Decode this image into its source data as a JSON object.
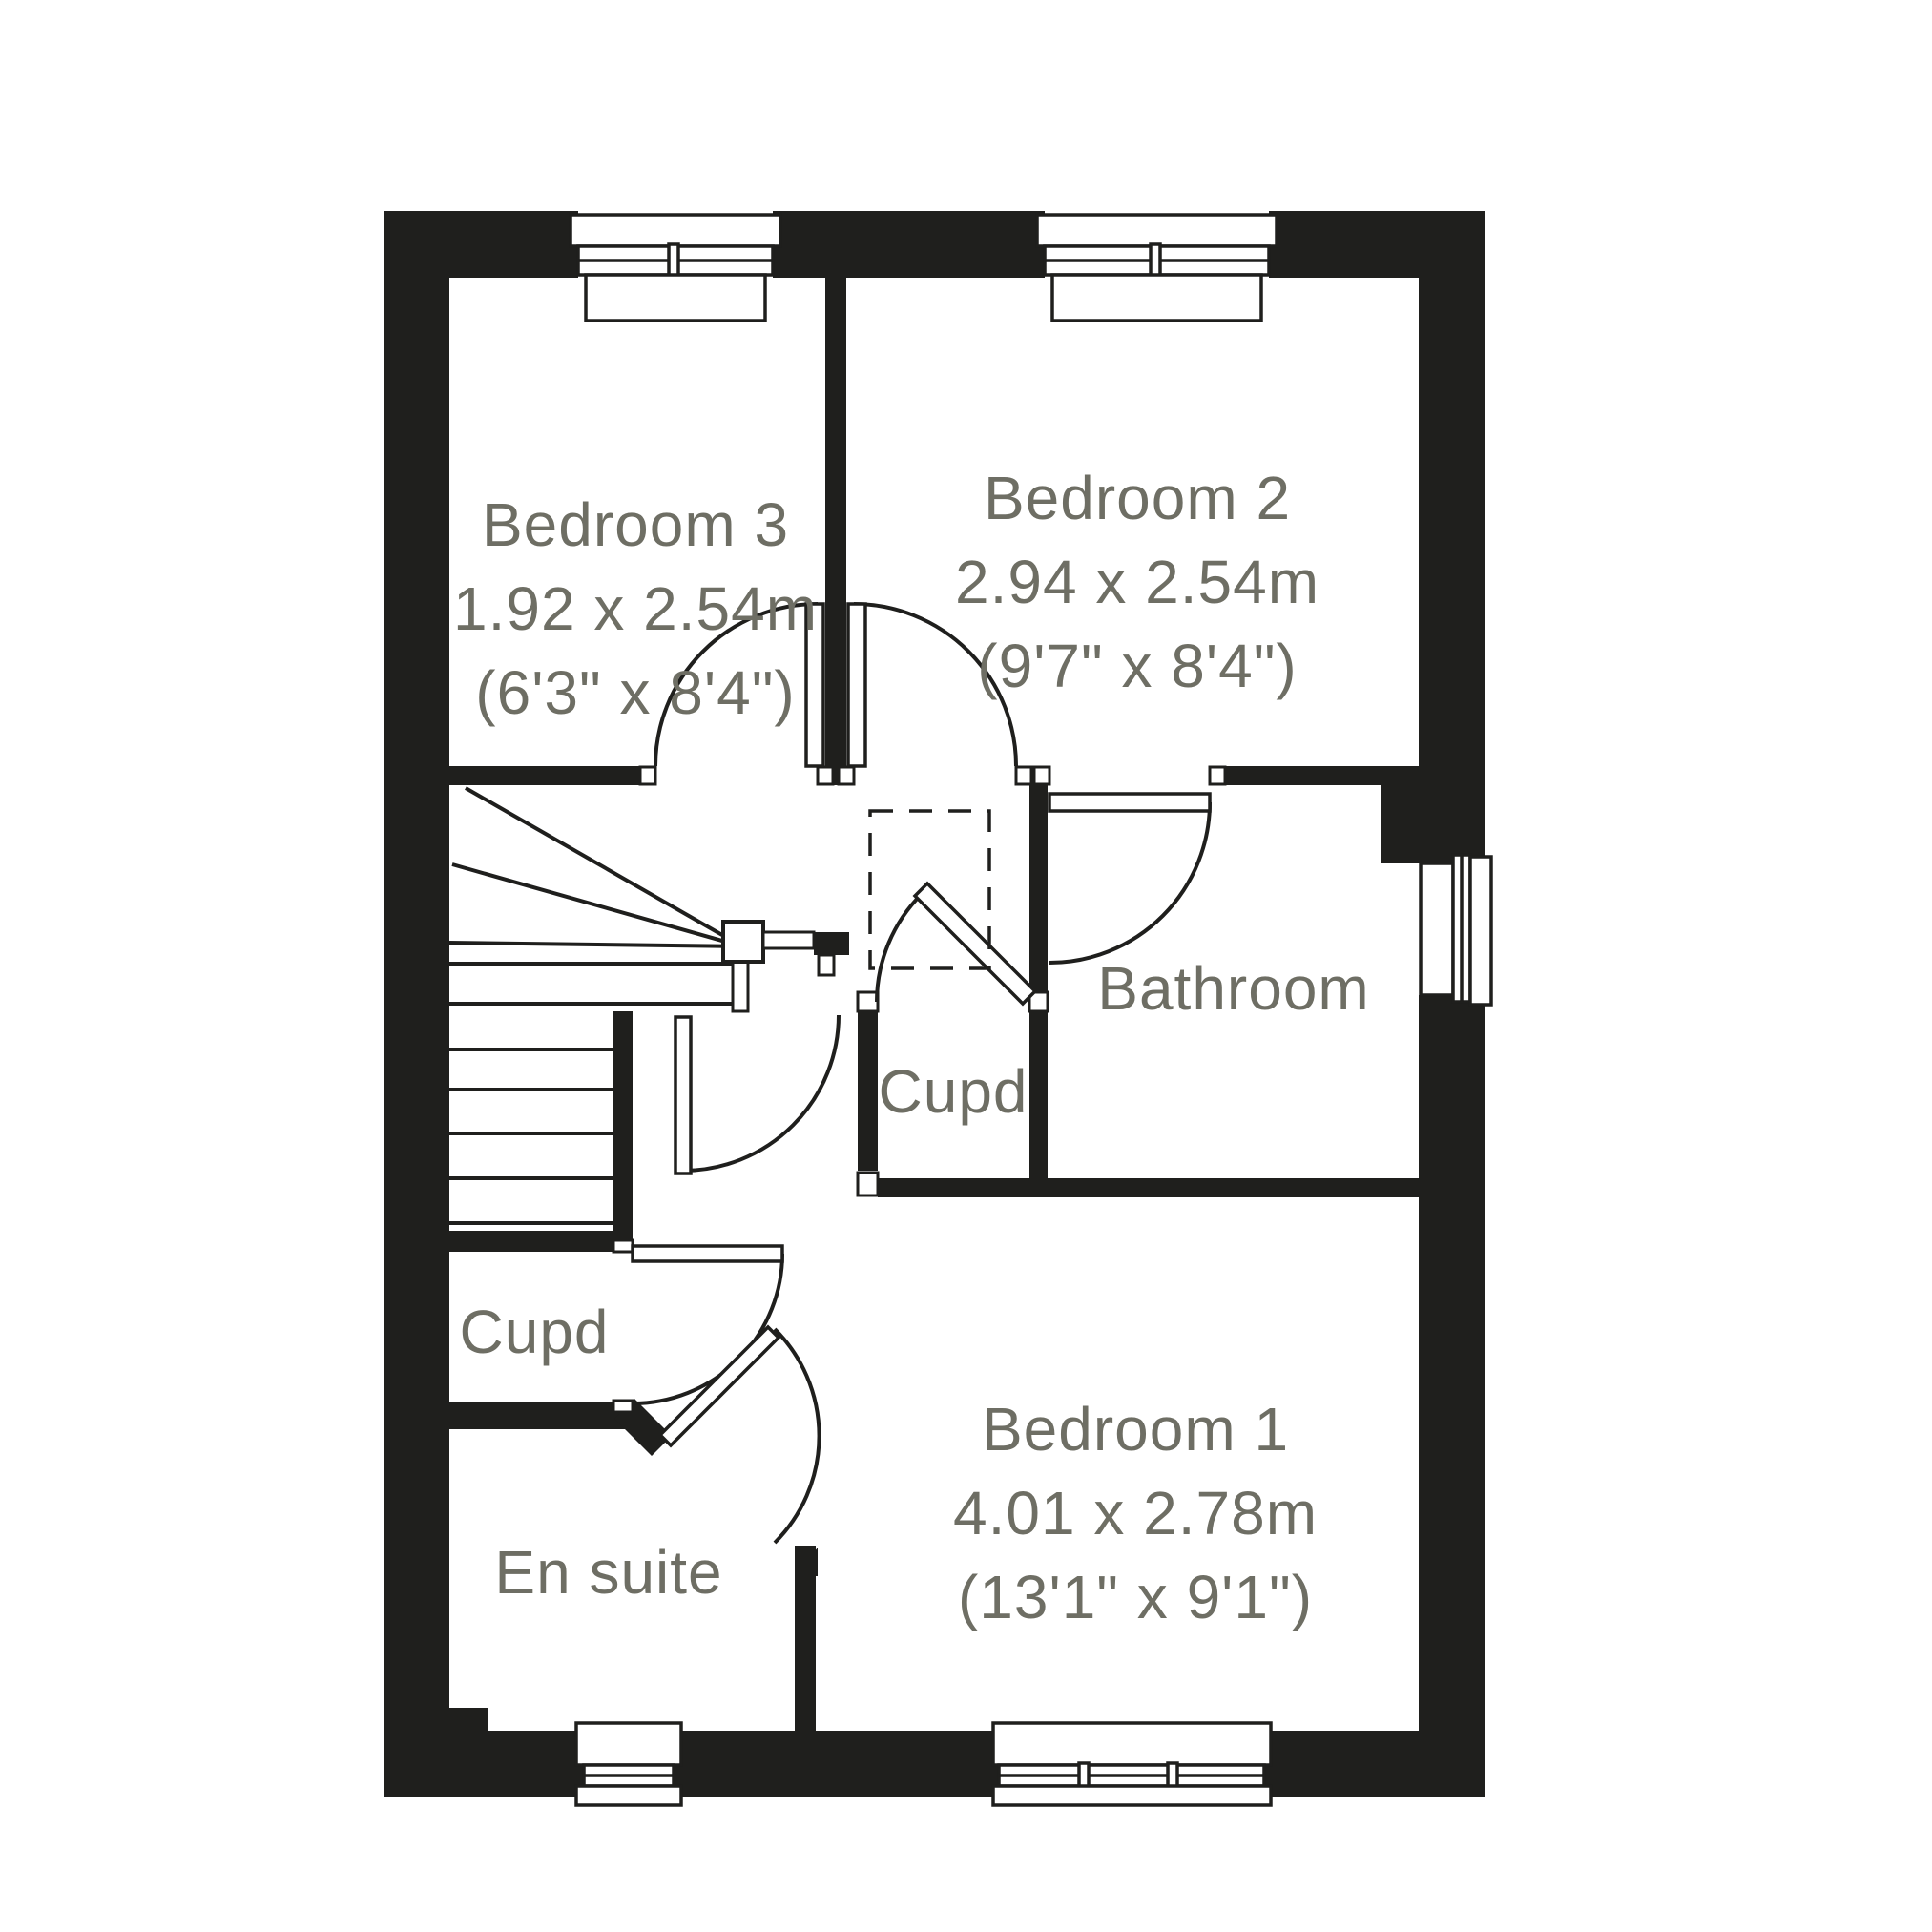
{
  "colors": {
    "wall": "#1f1f1d",
    "line": "#1f1f1d",
    "label_text": "#6e6e64",
    "background": "#ffffff"
  },
  "rooms": {
    "bedroom3": {
      "name": "Bedroom 3",
      "metric": "1.92 x 2.54m",
      "imperial": "(6'3\" x 8'4\")"
    },
    "bedroom2": {
      "name": "Bedroom 2",
      "metric": "2.94 x 2.54m",
      "imperial": "(9'7\" x 8'4\")"
    },
    "bedroom1": {
      "name": "Bedroom 1",
      "metric": "4.01 x 2.78m",
      "imperial": "(13'1\" x 9'1\")"
    },
    "bathroom": {
      "name": "Bathroom"
    },
    "cupboard_landing": {
      "name": "Cupd"
    },
    "cupboard_understairs": {
      "name": "Cupd"
    },
    "ensuite": {
      "name": "En suite"
    }
  }
}
